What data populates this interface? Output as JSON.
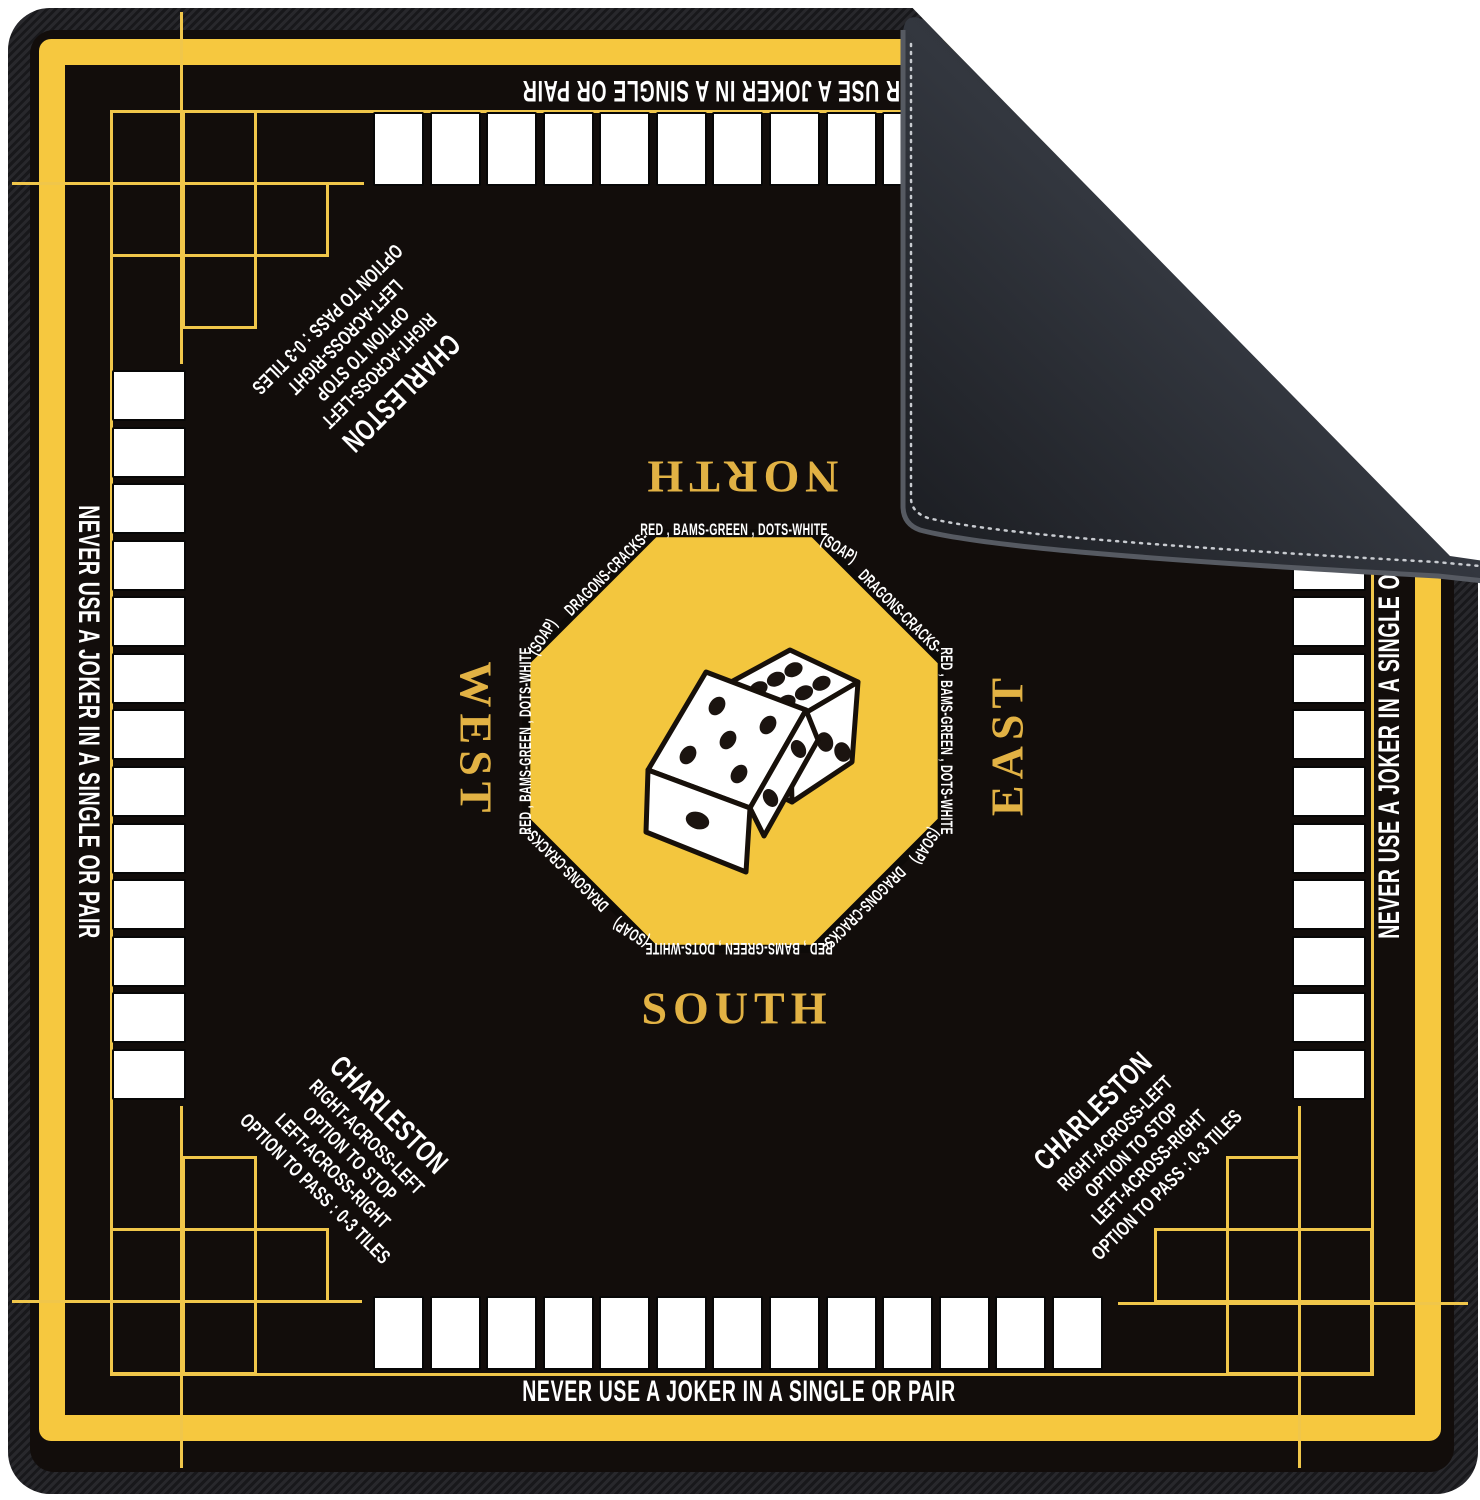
{
  "mat": {
    "edge_warning": "NEVER USE A JOKER IN A SINGLE OR PAIR",
    "directions": {
      "north": "NORTH",
      "south": "SOUTH",
      "east": "EAST",
      "west": "WEST"
    },
    "charleston": {
      "title": "CHARLESTON",
      "lines": [
        "RIGHT-ACROSS-LEFT",
        "OPTION TO STOP",
        "LEFT-ACROSS-RIGHT",
        "OPTION TO PASS :  0-3 TILES"
      ]
    },
    "octagon": {
      "edge_label": "RED , BAMS-GREEN , DOTS-WHITE",
      "diagonal_label": "DRAGONS-CRACKS-",
      "corner_label": "(SOAP)"
    },
    "racks": {
      "tiles_per_rack": 13,
      "rack_count": 4
    },
    "dice": [
      {
        "top_face": 5,
        "left_face": 1,
        "right_face": 2
      },
      {
        "top_face": 6,
        "right_face": 3
      }
    ],
    "colors": {
      "mat_black": "#120d0b",
      "border_yellow": "#F6C83F",
      "thin_line_yellow": "#F0C64A",
      "octagon_yellow": "#F3C63E",
      "gold_text": "#E2B244",
      "tile_white": "#ffffff",
      "flap_back": "#2b2e34",
      "binding": "#1e1e21"
    }
  }
}
